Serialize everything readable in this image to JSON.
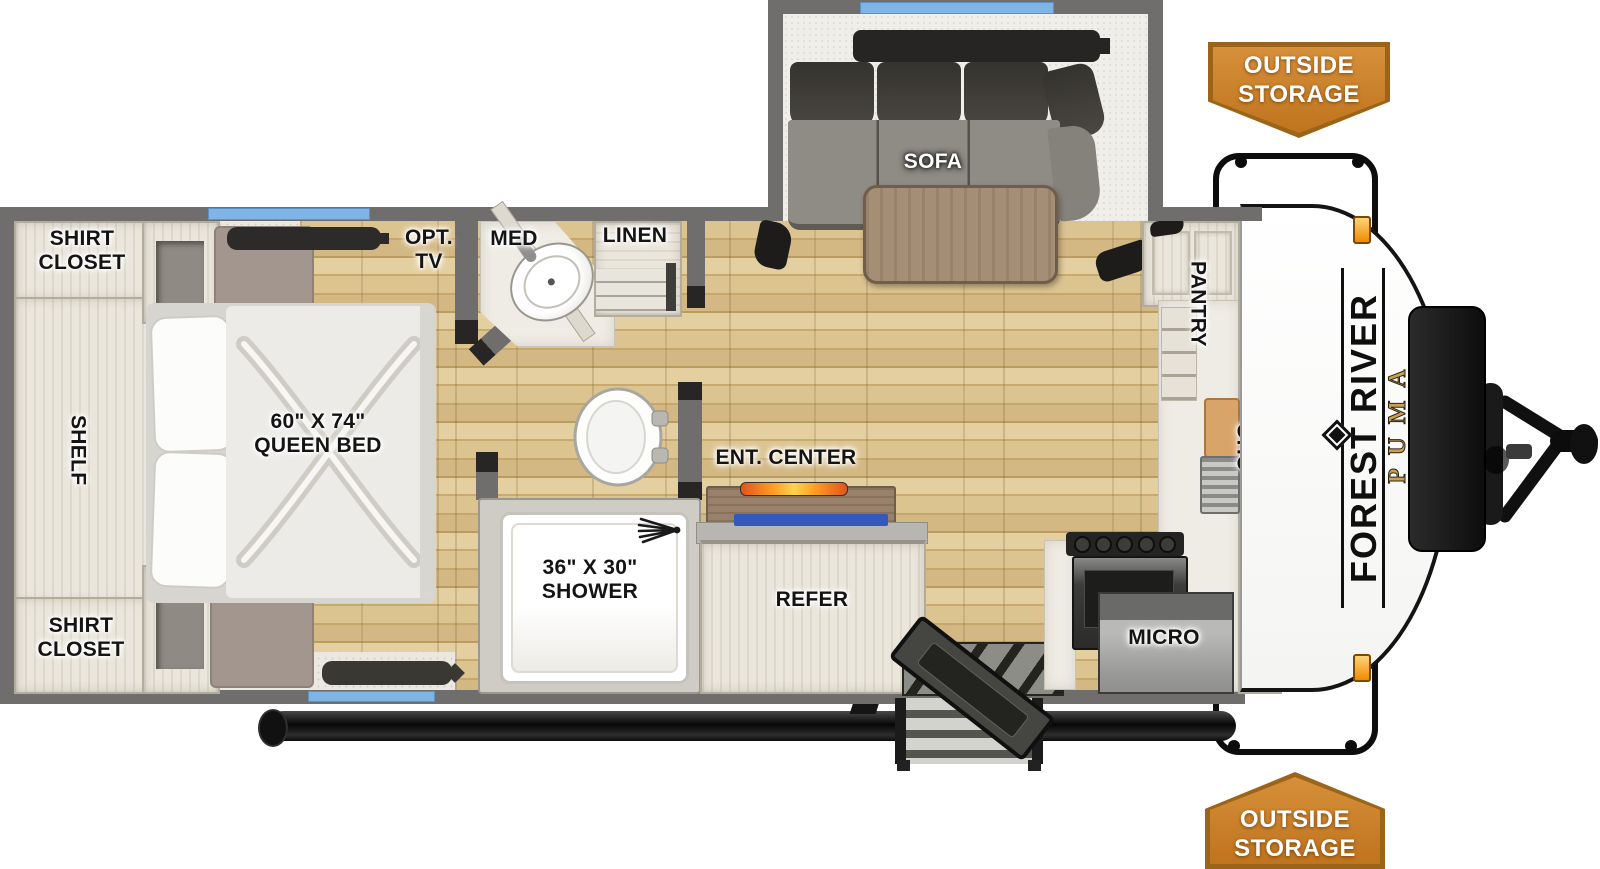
{
  "branding": {
    "make": "FOREST RIVER",
    "model": "PUMA"
  },
  "badges": {
    "outside_storage_top": "OUTSIDE\nSTORAGE",
    "outside_storage_bottom": "OUTSIDE\nSTORAGE"
  },
  "bedroom": {
    "shirt_closet_top": "SHIRT\nCLOSET",
    "shelf": "SHELF",
    "shirt_closet_bottom": "SHIRT\nCLOSET",
    "queen_bed": "60\" X 74\"\nQUEEN BED",
    "opt_tv": "OPT.\nTV"
  },
  "bathroom": {
    "med": "MED",
    "linen": "LINEN",
    "shower": "36\" X 30\"\nSHOWER"
  },
  "living": {
    "sofa": "SOFA",
    "ent_center": "ENT. CENTER",
    "refer": "REFER"
  },
  "kitchen": {
    "pantry": "PANTRY",
    "ohc": "OHC",
    "micro": "MICRO"
  },
  "icons": {
    "shower_head": "spray-fan",
    "entry_steps": "fold-out-steps",
    "hitch": "a-frame-hitch"
  },
  "colors": {
    "badge_orange": "#c8802c",
    "window_blue": "#7fb5e6",
    "wood_floor": "#d0b27c",
    "wall_gray": "#6f6e6c",
    "puma_gold": "#c7a055",
    "flame_orange": "#ff9d1f"
  }
}
